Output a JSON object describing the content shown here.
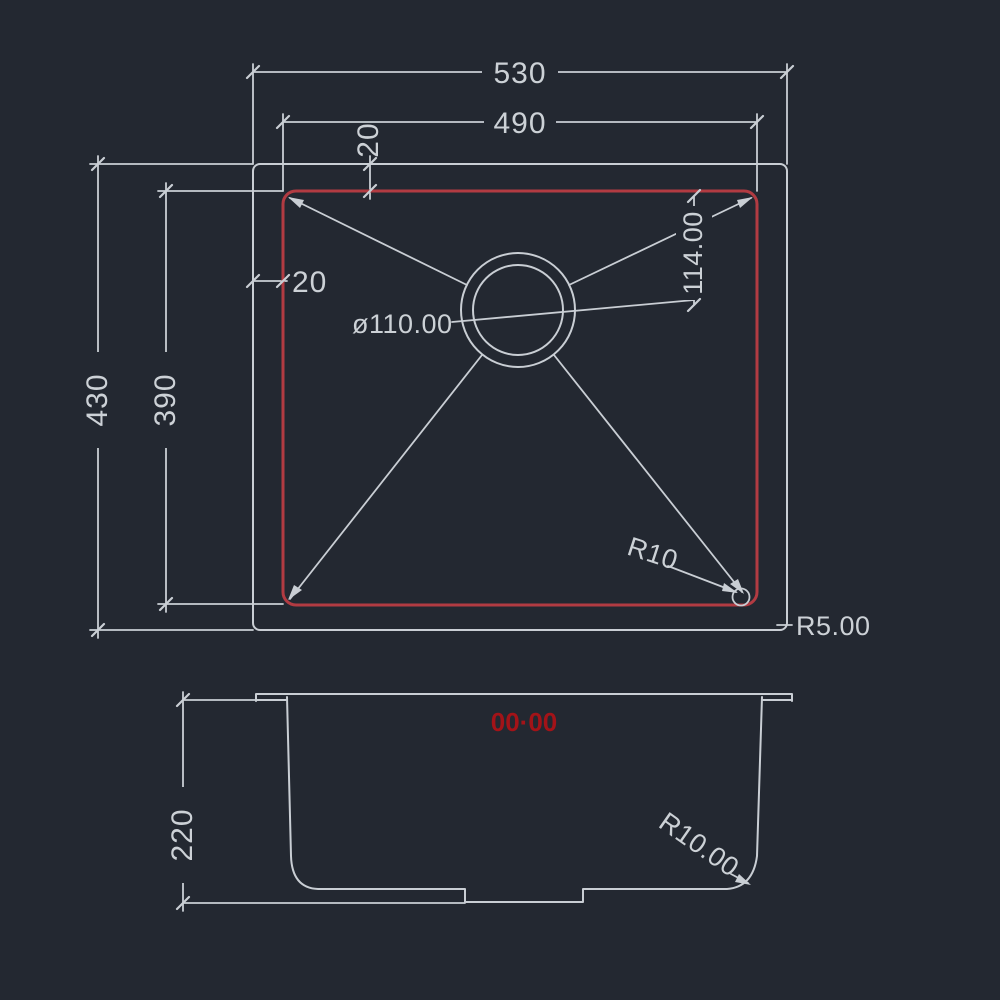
{
  "drawing": {
    "type": "sink-technical-drawing",
    "colors": {
      "background": "#232831",
      "line": "#c9ced4",
      "inner_bowl_outline": "#b23b42",
      "red_mark_text": "#a31318"
    },
    "top_view": {
      "overall_width": "530",
      "bowl_width": "490",
      "top_offset": "20",
      "side_offset": "20",
      "overall_depth": "430",
      "bowl_depth": "390",
      "drain_offset": "114.00",
      "drain_diameter": "ø110.00",
      "bowl_corner_radius": "R10",
      "outer_corner_radius": "R5.00"
    },
    "section_view": {
      "bowl_height": "220",
      "bottom_corner_radius": "R10.00",
      "red_mark": "00·00"
    }
  }
}
